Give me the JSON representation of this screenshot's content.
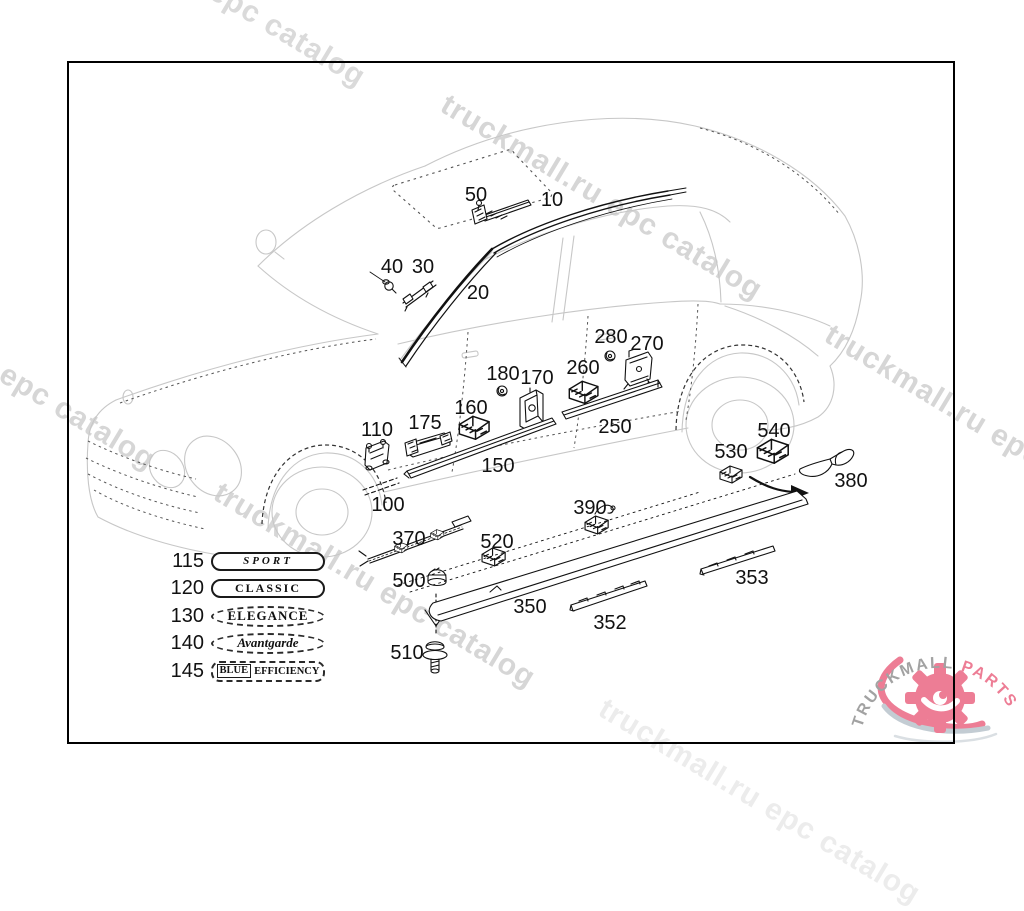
{
  "watermark": {
    "text": "truckmall.ru epc catalog",
    "angle_deg": 31,
    "instances": [
      {
        "x": 55,
        "y": -125,
        "color": "#dadada",
        "size": 30
      },
      {
        "x": 452,
        "y": 88,
        "color": "#d6d6d6",
        "size": 30
      },
      {
        "x": 836,
        "y": 318,
        "color": "#d6d6d6",
        "size": 30
      },
      {
        "x": -155,
        "y": 258,
        "color": "#d6d6d6",
        "size": 30
      },
      {
        "x": 225,
        "y": 476,
        "color": "#d6d6d6",
        "size": 30
      },
      {
        "x": 610,
        "y": 692,
        "color": "#ececec",
        "size": 30
      }
    ]
  },
  "diagram": {
    "parts": [
      {
        "label": "50",
        "x": 476,
        "y": 195
      },
      {
        "label": "10",
        "x": 552,
        "y": 200
      },
      {
        "label": "40",
        "x": 392,
        "y": 267
      },
      {
        "label": "30",
        "x": 423,
        "y": 267
      },
      {
        "label": "20",
        "x": 478,
        "y": 293
      },
      {
        "label": "280",
        "x": 611,
        "y": 337
      },
      {
        "label": "270",
        "x": 647,
        "y": 344
      },
      {
        "label": "180",
        "x": 503,
        "y": 374
      },
      {
        "label": "170",
        "x": 537,
        "y": 378
      },
      {
        "label": "260",
        "x": 583,
        "y": 368
      },
      {
        "label": "160",
        "x": 471,
        "y": 408
      },
      {
        "label": "175",
        "x": 425,
        "y": 423
      },
      {
        "label": "110",
        "x": 377,
        "y": 430
      },
      {
        "label": "250",
        "x": 615,
        "y": 427
      },
      {
        "label": "150",
        "x": 498,
        "y": 466
      },
      {
        "label": "100",
        "x": 388,
        "y": 505
      },
      {
        "label": "540",
        "x": 774,
        "y": 431
      },
      {
        "label": "530",
        "x": 731,
        "y": 452
      },
      {
        "label": "380",
        "x": 851,
        "y": 481
      },
      {
        "label": "390",
        "x": 590,
        "y": 508
      },
      {
        "label": "370",
        "x": 409,
        "y": 539
      },
      {
        "label": "520",
        "x": 497,
        "y": 542
      },
      {
        "label": "500",
        "x": 409,
        "y": 581
      },
      {
        "label": "350",
        "x": 530,
        "y": 607
      },
      {
        "label": "352",
        "x": 610,
        "y": 623
      },
      {
        "label": "353",
        "x": 752,
        "y": 578
      },
      {
        "label": "510",
        "x": 407,
        "y": 653
      }
    ]
  },
  "legend": {
    "items": [
      {
        "ref": "115",
        "text": "SPORT",
        "shape": "pill-solid",
        "style": "sport"
      },
      {
        "ref": "120",
        "text": "CLASSIC",
        "shape": "pill-solid",
        "style": "classic"
      },
      {
        "ref": "130",
        "text": "ELEGANCE",
        "shape": "oval-dashed",
        "style": "elegance"
      },
      {
        "ref": "140",
        "text": "Avantgarde",
        "shape": "oval-dashed",
        "style": "avantgarde"
      },
      {
        "ref": "145",
        "text": "BLUE EFFICIENCY",
        "boxed_prefix": "BLUE",
        "shape": "rect-dashed",
        "style": "blue-efficiency"
      }
    ]
  },
  "logo": {
    "text_primary": "TRUCKMALL",
    "text_accent": "PARTS",
    "color_primary": "#a2a2a2",
    "color_accent": "#ed7d95"
  }
}
